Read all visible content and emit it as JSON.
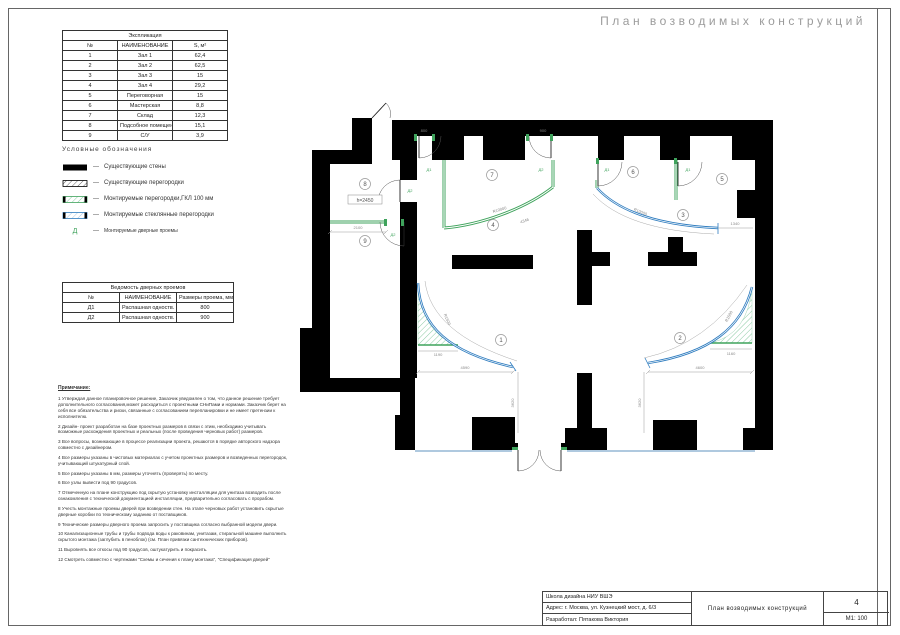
{
  "page": {
    "title": "План возводимых конструкций"
  },
  "exp_table": {
    "title": "Экспликация",
    "col_num": "№",
    "col_name": "НАИМЕНОВАНИЕ",
    "col_area": "S, м²",
    "rows": [
      {
        "num": "1",
        "name": "Зал 1",
        "area": "62,4"
      },
      {
        "num": "2",
        "name": "Зал 2",
        "area": "62,5"
      },
      {
        "num": "3",
        "name": "Зал 3",
        "area": "15"
      },
      {
        "num": "4",
        "name": "Зал 4",
        "area": "29,2"
      },
      {
        "num": "5",
        "name": "Переговорная",
        "area": "15"
      },
      {
        "num": "6",
        "name": "Мастерская",
        "area": "8,8"
      },
      {
        "num": "7",
        "name": "Склад",
        "area": "12,3"
      },
      {
        "num": "8",
        "name": "Подсобное помещение",
        "area": "15,1"
      },
      {
        "num": "9",
        "name": "С/У",
        "area": "3,9"
      }
    ]
  },
  "legend": {
    "title": "Условные обозначения",
    "dash": "—",
    "door_glyph": "Д",
    "items": [
      {
        "label": "Существующие стены"
      },
      {
        "label": "Существующие перегородки"
      },
      {
        "label": "Монтируемые перегородки,ГКЛ 100 мм"
      },
      {
        "label": "Монтируемые стеклянные перегородки"
      },
      {
        "label": "Монтируемые дверные проемы"
      }
    ]
  },
  "door_table": {
    "title": "Ведомость дверных проемов",
    "col_num": "№",
    "col_name": "НАИМЕНОВАНИЕ",
    "col_size": "Размеры проема, мм",
    "rows": [
      {
        "num": "Д1",
        "name": "Распашная одноств.",
        "size": "800"
      },
      {
        "num": "Д2",
        "name": "Распашная одноств.",
        "size": "900"
      }
    ]
  },
  "notes": {
    "title": "Примечание:",
    "items": [
      "1 Утверждая данное планировочное решение, Заказчик уведомлен о том, что данное решение требует дополнительного согласования,может расходиться с проектными СНиПами и нормами. Заказчик берет на себя все обязательства и риски, связанные с согласованием перепланировки и не имеет претензии к исполнителю.",
      "2 Дизайн- проект разработан на базе проектных размеров в связи с этим, необходимо учитывать возможные расхождения проектных и реальных (после проведения черновых работ) размеров.",
      "3 Все вопросы, возникающие в процессе реализации проекта, решаются в порядке авторского надзора совместно с дизайнером.",
      "4 Все размеры указаны в чистовых материалах с учетом проектных размеров и возведенных перегородок, учитывающий штукатурный слой.",
      "5 Все размеры указаны в мм, размеры уточнять (проверять) по месту.",
      "6 Все узлы вывести под 90 градусов.",
      "7 Отмеченную на плане конструкцию под скрытую установку инсталляции для унитаза возводить после ознакомления с технической документацией инсталляции, предварительно согласовать с прорабом.",
      "8 Учесть монтажные проемы дверей при возведении стен. На этапе черновых работ установить скрытые дверные коробки по техническому заданию от поставщиков.",
      "9 Технические размеры дверного проема запросить у поставщика согласно выбранной модели двери.",
      "10 Канализационные трубы и трубы подвода воды к раковинам, унитазам, стиральной машине выполнить скрытого монтажа (заглубить в пеноблок) (см. План привязки сантехнических приборов).",
      "11 Выровнять все откосы под 90 градусов, оштукатурить и покрасить.",
      "12 Смотреть совместно с чертежами \"Схемы и сечения к плану монтажа\", \"Спецификация дверей\""
    ]
  },
  "plan": {
    "rooms": [
      "1",
      "2",
      "3",
      "4",
      "5",
      "6",
      "7",
      "8",
      "9"
    ],
    "height_mark": "h=2450",
    "door_marks": [
      "Д1",
      "Д2",
      "Д1",
      "Д1",
      "Д2",
      "Д2"
    ],
    "dims": {
      "d2100": "2100",
      "d4590": "4590",
      "d4600": "4600",
      "d3620a": "3620",
      "d3620b": "3620",
      "d1190": "1190",
      "d1160": "1160",
      "d1340": "1340",
      "r10000a": "R10000",
      "r10000b": "R10000",
      "d4346": "4346",
      "r1500a": "R1500",
      "r1500b": "R1500",
      "d800": "800",
      "d900": "900"
    }
  },
  "titleblock": {
    "row1": "Школа дизайна НИУ ВШЭ",
    "row2": "Адрес: г. Москва, ул. Кузнецкий мост, д. 6/3",
    "row3": "Разработал: Пятакова Виктория",
    "drawing": "План возводимых конструкций",
    "sheet": "4",
    "scale": "М1: 100"
  },
  "colors": {
    "partition_green": "#3FA35C",
    "glass_blue": "#2E7CBF",
    "window_blue": "#AFC9DF",
    "title_gray": "#9B9B9B"
  }
}
